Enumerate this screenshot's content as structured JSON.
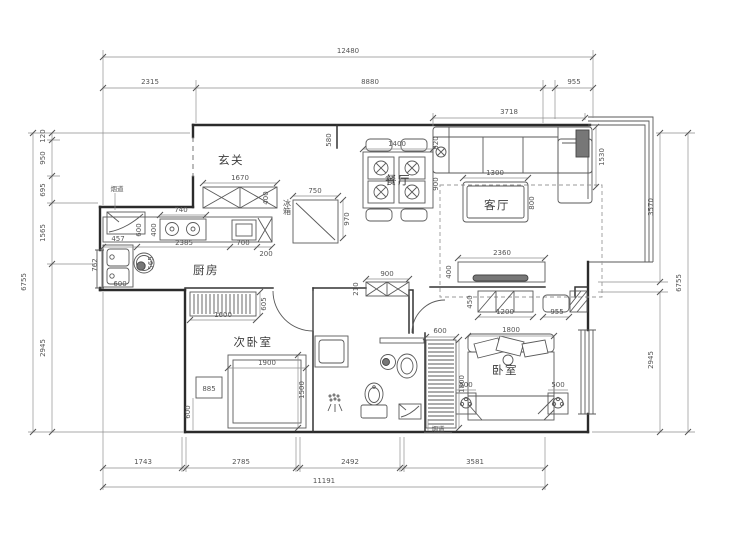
{
  "title": "apartment-floor-plan",
  "colors": {
    "background": "#ffffff",
    "wall": "#2b2b2b",
    "furniture": "#5a5a5a",
    "dimension": "#555555"
  },
  "rooms": {
    "entry": "玄关",
    "kitchen": "厨房",
    "dining": "餐厅",
    "living": "客厅",
    "bedroom": "卧室",
    "bedroom2": "次卧室"
  },
  "labels": {
    "fridge": "冰箱",
    "flue_top": "烟道",
    "flue_bottom": "烟道"
  },
  "dims": {
    "t_total": "12480",
    "t1": "2315",
    "t2": "8880",
    "t3": "955",
    "living_w": "3718",
    "l1": "120",
    "l2": "950",
    "l3": "695",
    "l4": "1565",
    "l5": "2945",
    "l_total": "6755",
    "r1": "3570",
    "r2": "2945",
    "r_total": "6755",
    "b1": "1743",
    "b2": "2785",
    "b3": "2492",
    "b4": "3581",
    "b_total": "11191",
    "shoe_w": "1670",
    "shoe_d": "400",
    "wall_580": "580",
    "stove_w": "740",
    "stove_d": "400",
    "counter_d": "600",
    "c1": "2385",
    "c2": "700",
    "c3": "200",
    "sink_w": "457",
    "sink_d": "762",
    "washer": "565",
    "sink_b": "600",
    "fridge_w": "750",
    "fridge_d": "970",
    "table_w": "1400",
    "table_gap": "820",
    "table_d": "900",
    "coffee_w": "1300",
    "coffee_d": "800",
    "sofa_l": "1530",
    "tv_w": "2360",
    "tv_d": "400",
    "dresser_w": "1200",
    "dresser_d": "450",
    "stool_w": "955",
    "bed_w": "1800",
    "ward_w": "600",
    "ward_l": "1800",
    "ns_l": "500",
    "ns_r": "500",
    "store_w": "900",
    "store_d": "210",
    "cab2_w": "1600",
    "cab2_d": "605",
    "bed2_w": "1900",
    "bed2_d": "1500",
    "ns2": "885",
    "gap2": "600"
  }
}
